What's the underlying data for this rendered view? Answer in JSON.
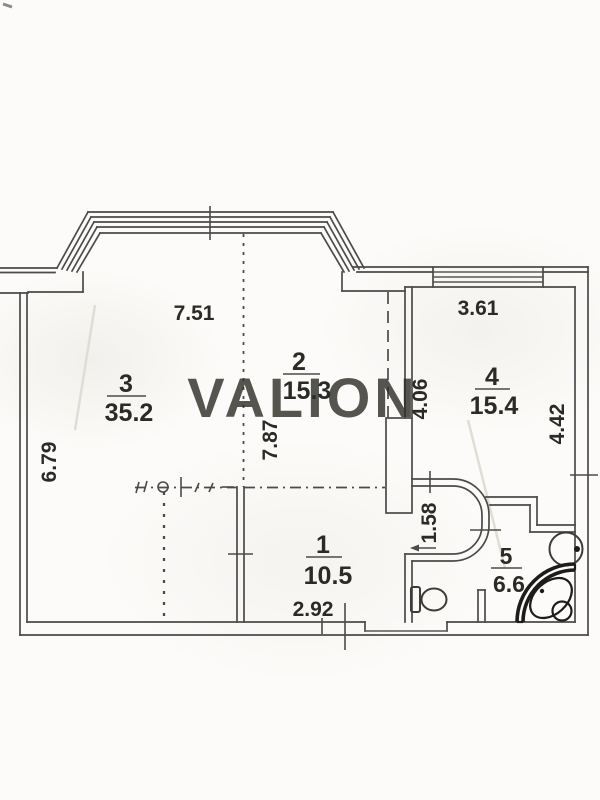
{
  "watermark": "VALION",
  "rooms": [
    {
      "number": "3",
      "area": "35.2"
    },
    {
      "number": "2",
      "area": "15.3"
    },
    {
      "number": "4",
      "area": "15.4"
    },
    {
      "number": "1",
      "area": "10.5"
    },
    {
      "number": "5",
      "area": "6.6"
    }
  ],
  "dimensions": {
    "width_top": "7.51",
    "room4_width": "3.61",
    "left_height": "6.79",
    "mid_height": "7.87",
    "room4_height_left": "4.06",
    "room4_height_right": "4.42",
    "hall_width": "1.58",
    "bottom_width": "2.92"
  },
  "colors": {
    "line": "#4b4b49",
    "text": "#2a2a28",
    "watermark": "#c6c6c3",
    "paper": "#fcfbf9"
  }
}
